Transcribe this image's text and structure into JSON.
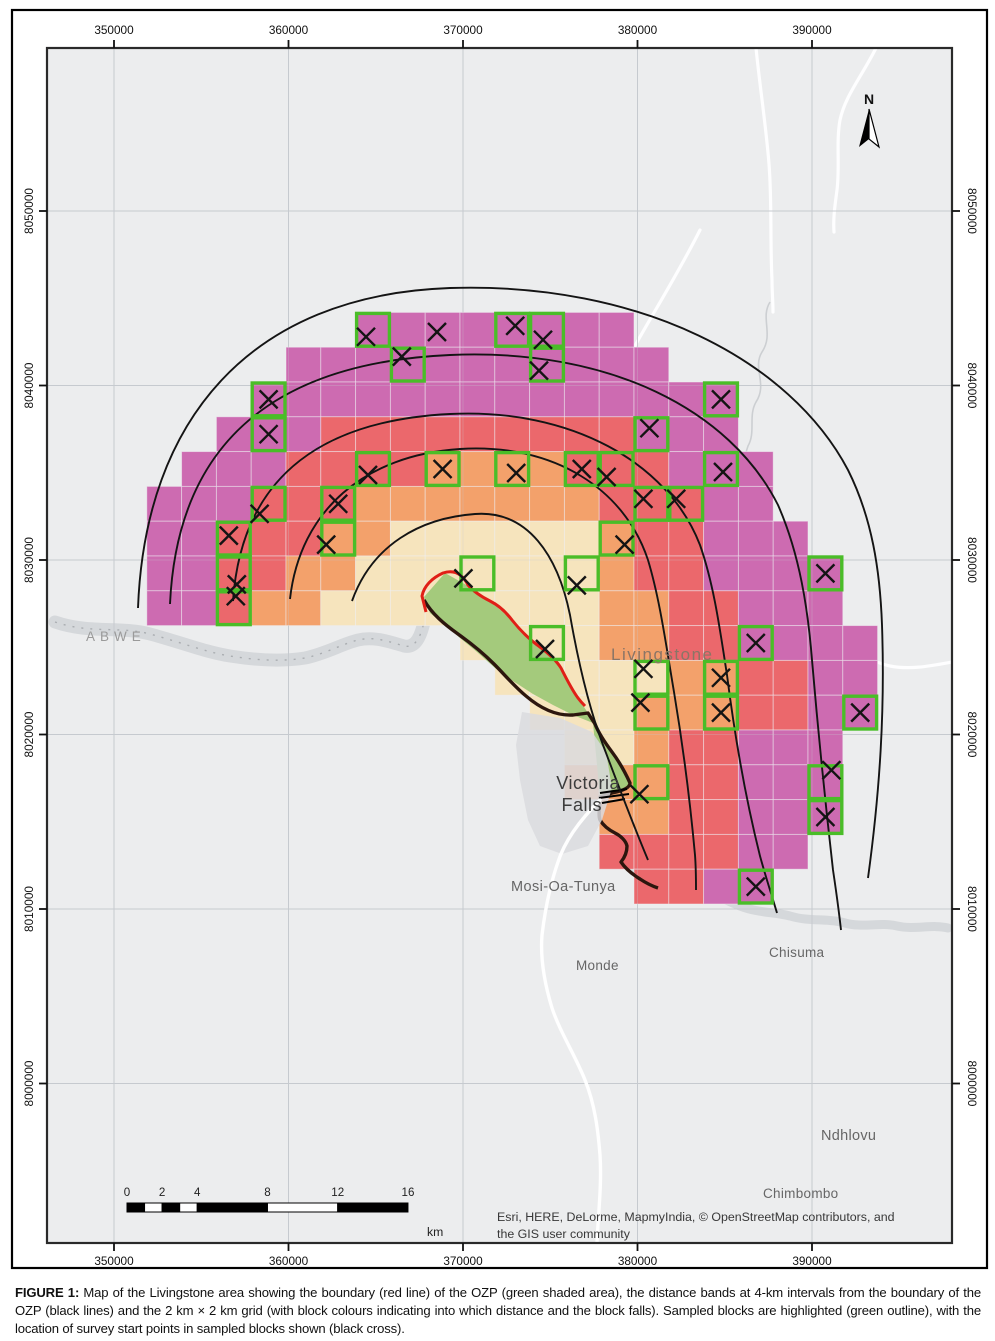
{
  "figure": {
    "caption_label": "FIGURE 1:",
    "caption_text": " Map of the Livingstone area showing the boundary (red line) of the OZP (green shaded area), the distance bands at 4-km intervals from the boundary of the OZP (black lines) and the 2 km × 2 km grid (with block colours indicating into which distance and the block falls). Sampled blocks are highlighted (green outline), with the location of survey start points in sampled blocks shown (black cross)."
  },
  "attribution": {
    "line1": "Esri, HERE, DeLorme, MapmyIndia, © OpenStreetMap contributors, and",
    "line2": "the GIS user community"
  },
  "north": {
    "label": "N",
    "x": 869,
    "y": 103
  },
  "scalebar": {
    "unit": "km",
    "x0": 127,
    "y0": 1203,
    "h": 9,
    "px_per_km": 17.56,
    "ticks": [
      {
        "label": "0",
        "km": 0
      },
      {
        "label": "2",
        "km": 2
      },
      {
        "label": "4",
        "km": 4
      },
      {
        "label": "8",
        "km": 8
      },
      {
        "label": "12",
        "km": 12
      },
      {
        "label": "16",
        "km": 16
      }
    ],
    "segments": [
      [
        0,
        1,
        "black"
      ],
      [
        1,
        2,
        "white"
      ],
      [
        2,
        3,
        "black"
      ],
      [
        3,
        4,
        "white"
      ],
      [
        4,
        8,
        "black"
      ],
      [
        8,
        12,
        "white"
      ],
      [
        12,
        16,
        "black"
      ]
    ],
    "unit_x": 427,
    "unit_y": 1236
  },
  "axes": {
    "x_ticks": [
      {
        "label": "350000",
        "x": 114
      },
      {
        "label": "360000",
        "x": 288.5
      },
      {
        "label": "370000",
        "x": 463
      },
      {
        "label": "380000",
        "x": 637.5
      },
      {
        "label": "390000",
        "x": 812
      }
    ],
    "y_ticks": [
      {
        "label": "8050000",
        "y": 211
      },
      {
        "label": "8040000",
        "y": 385.5
      },
      {
        "label": "8030000",
        "y": 560
      },
      {
        "label": "8020000",
        "y": 734.5
      },
      {
        "label": "8010000",
        "y": 909
      },
      {
        "label": "8000000",
        "y": 1083.5
      }
    ]
  },
  "map": {
    "page_border": {
      "x": 12,
      "y": 10,
      "w": 975,
      "h": 1258
    },
    "frame": {
      "x": 47,
      "y": 48,
      "w": 905,
      "h": 1195
    },
    "grid_origin": {
      "x": 112,
      "y": 208,
      "cell": 34.8
    },
    "colors": {
      "bg": "#ecedee",
      "magenta": "#cd6bb1",
      "red": "#eb686c",
      "orange": "#f3a16b",
      "cream": "#f6e4bd",
      "ozp_green": "#a4ca7c",
      "sample_outline": "#4abd28",
      "ozp_boundary_red": "#e01f17",
      "river_dark": "#2c160e",
      "arc": "#141414",
      "grid": "#c6cacf",
      "water": "#d3d5d8",
      "road": "#ffffff",
      "frame_stroke": "#2a2a2a",
      "label_gray": "#666666",
      "cross": "#141414"
    },
    "band_legend": [
      {
        "band": "0-4 km",
        "color_key": "cream"
      },
      {
        "band": "4-8 km",
        "color_key": "orange"
      },
      {
        "band": "8-12 km",
        "color_key": "red"
      },
      {
        "band": "12-16 km",
        "color_key": "magenta"
      }
    ],
    "blocks": [
      {
        "r": 3,
        "runs": [
          [
            7,
            14,
            "magenta"
          ]
        ]
      },
      {
        "r": 4,
        "runs": [
          [
            5,
            15,
            "magenta"
          ]
        ]
      },
      {
        "r": 5,
        "runs": [
          [
            4,
            17,
            "magenta"
          ]
        ]
      },
      {
        "r": 6,
        "runs": [
          [
            3,
            5,
            "magenta"
          ],
          [
            6,
            14,
            "red"
          ],
          [
            15,
            17,
            "magenta"
          ]
        ]
      },
      {
        "r": 7,
        "runs": [
          [
            2,
            4,
            "magenta"
          ],
          [
            5,
            8,
            "red"
          ],
          [
            9,
            12,
            "orange"
          ],
          [
            13,
            15,
            "red"
          ],
          [
            16,
            18,
            "magenta"
          ]
        ]
      },
      {
        "r": 8,
        "runs": [
          [
            1,
            3,
            "magenta"
          ],
          [
            4,
            6,
            "red"
          ],
          [
            7,
            13,
            "orange"
          ],
          [
            14,
            16,
            "red"
          ],
          [
            17,
            18,
            "magenta"
          ]
        ]
      },
      {
        "r": 9,
        "runs": [
          [
            1,
            2,
            "magenta"
          ],
          [
            3,
            5,
            "red"
          ],
          [
            6,
            7,
            "orange"
          ],
          [
            8,
            13,
            "cream"
          ],
          [
            14,
            14,
            "orange"
          ],
          [
            15,
            16,
            "red"
          ],
          [
            17,
            19,
            "magenta"
          ]
        ]
      },
      {
        "r": 10,
        "runs": [
          [
            1,
            2,
            "magenta"
          ],
          [
            3,
            4,
            "red"
          ],
          [
            5,
            6,
            "orange"
          ],
          [
            7,
            13,
            "cream"
          ],
          [
            14,
            14,
            "orange"
          ],
          [
            15,
            16,
            "red"
          ],
          [
            17,
            20,
            "magenta"
          ]
        ]
      },
      {
        "r": 11,
        "runs": [
          [
            1,
            2,
            "magenta"
          ],
          [
            3,
            3,
            "red"
          ],
          [
            4,
            5,
            "orange"
          ],
          [
            6,
            13,
            "cream"
          ],
          [
            14,
            15,
            "orange"
          ],
          [
            16,
            17,
            "red"
          ],
          [
            18,
            20,
            "magenta"
          ]
        ]
      },
      {
        "r": 12,
        "runs": [
          [
            10,
            13,
            "cream"
          ],
          [
            14,
            15,
            "orange"
          ],
          [
            16,
            17,
            "red"
          ],
          [
            18,
            21,
            "magenta"
          ]
        ]
      },
      {
        "r": 13,
        "runs": [
          [
            11,
            15,
            "cream"
          ],
          [
            16,
            17,
            "orange"
          ],
          [
            18,
            19,
            "red"
          ],
          [
            20,
            21,
            "magenta"
          ]
        ]
      },
      {
        "r": 14,
        "runs": [
          [
            12,
            14,
            "cream"
          ],
          [
            15,
            17,
            "orange"
          ],
          [
            18,
            19,
            "red"
          ],
          [
            20,
            21,
            "magenta"
          ]
        ]
      },
      {
        "r": 15,
        "runs": [
          [
            13,
            14,
            "cream"
          ],
          [
            15,
            15,
            "orange"
          ],
          [
            16,
            17,
            "red"
          ],
          [
            18,
            20,
            "magenta"
          ]
        ]
      },
      {
        "r": 16,
        "runs": [
          [
            13,
            15,
            "orange"
          ],
          [
            16,
            17,
            "red"
          ],
          [
            18,
            20,
            "magenta"
          ]
        ]
      },
      {
        "r": 17,
        "runs": [
          [
            14,
            15,
            "orange"
          ],
          [
            16,
            17,
            "red"
          ],
          [
            18,
            20,
            "magenta"
          ]
        ]
      },
      {
        "r": 18,
        "runs": [
          [
            14,
            17,
            "red"
          ],
          [
            18,
            19,
            "magenta"
          ]
        ]
      },
      {
        "r": 19,
        "runs": [
          [
            15,
            16,
            "red"
          ],
          [
            17,
            18,
            "magenta"
          ]
        ]
      }
    ],
    "sampled_blocks": [
      {
        "c": 7,
        "r": 3,
        "xo": -7,
        "yo": 7
      },
      {
        "c": 11,
        "r": 3,
        "xo": 3,
        "yo": -4
      },
      {
        "c": 12,
        "r": 3,
        "xo": -4,
        "yo": 10
      },
      {
        "c": 8,
        "r": 4,
        "xo": -6,
        "yo": -8
      },
      {
        "c": 12,
        "r": 4,
        "xo": -8,
        "yo": 6
      },
      {
        "c": 4,
        "r": 5,
        "xo": 0,
        "yo": 0
      },
      {
        "c": 17,
        "r": 5,
        "xo": 0,
        "yo": 0
      },
      {
        "c": 4,
        "r": 6,
        "xo": 0,
        "yo": 0
      },
      {
        "c": 15,
        "r": 6,
        "xo": -2,
        "yo": -6
      },
      {
        "c": 7,
        "r": 7,
        "xo": -5,
        "yo": 6
      },
      {
        "c": 9,
        "r": 7,
        "xo": 0,
        "yo": 0
      },
      {
        "c": 11,
        "r": 7,
        "xo": 4,
        "yo": 4
      },
      {
        "c": 13,
        "r": 7,
        "xo": 0,
        "yo": 0
      },
      {
        "c": 14,
        "r": 7,
        "xo": -10,
        "yo": 8
      },
      {
        "c": 17,
        "r": 7,
        "xo": 2,
        "yo": 3
      },
      {
        "c": 4,
        "r": 8,
        "xo": -9,
        "yo": 10
      },
      {
        "c": 6,
        "r": 8,
        "xo": 0,
        "yo": 0
      },
      {
        "c": 15,
        "r": 8,
        "xo": -8,
        "yo": -5
      },
      {
        "c": 16,
        "r": 8,
        "xo": -10,
        "yo": -5
      },
      {
        "c": 3,
        "r": 9,
        "xo": -5,
        "yo": -3
      },
      {
        "c": 6,
        "r": 9,
        "xo": -12,
        "yo": 6
      },
      {
        "c": 14,
        "r": 9,
        "xo": 8,
        "yo": 6
      },
      {
        "c": 3,
        "r": 10,
        "xo": 3,
        "yo": 11
      },
      {
        "c": 10,
        "r": 10,
        "xo": -14,
        "yo": 5
      },
      {
        "c": 13,
        "r": 10,
        "xo": -5,
        "yo": 12
      },
      {
        "c": 20,
        "r": 10,
        "xo": 0,
        "yo": 0
      },
      {
        "c": 3,
        "r": 11,
        "xo": 2,
        "yo": -12
      },
      {
        "c": 12,
        "r": 12,
        "xo": -2,
        "yo": 6
      },
      {
        "c": 18,
        "r": 12,
        "xo": 0,
        "yo": 0
      },
      {
        "c": 15,
        "r": 13,
        "xo": -8,
        "yo": -9
      },
      {
        "c": 17,
        "r": 13,
        "xo": 0,
        "yo": 0
      },
      {
        "c": 15,
        "r": 14,
        "xo": -11,
        "yo": -10
      },
      {
        "c": 17,
        "r": 14,
        "xo": 0,
        "yo": 0
      },
      {
        "c": 21,
        "r": 14,
        "xo": 0,
        "yo": 0
      },
      {
        "c": 15,
        "r": 16,
        "xo": -12,
        "yo": 12
      },
      {
        "c": 20,
        "r": 16,
        "xo": 6,
        "yo": -12
      },
      {
        "c": 20,
        "r": 17,
        "xo": 0,
        "yo": 0
      },
      {
        "c": 18,
        "r": 19,
        "xo": 0,
        "yo": 0
      }
    ],
    "loose_crosses": [
      {
        "x": 437,
        "y": 332
      }
    ],
    "arcs": [
      "M352,601 C372,545 420,518 475,514 C528,510 558,556 570,615 C577,655 588,705 603,745 C617,782 632,822 648,860",
      "M290,599 C300,510 365,455 460,449 C555,443 625,490 648,560 C660,600 666,645 674,692 C682,740 690,800 695,855 C696,868 696,878 696,890",
      "M233,601 C242,470 330,420 450,414 C570,408 668,462 700,545 C714,585 720,630 727,675 C735,738 746,800 760,856 C766,878 772,896 777,913",
      "M170,604 C178,430 290,362 450,355 C610,348 730,410 778,505 C800,555 808,610 812,660 C818,730 825,800 833,870 C836,890 839,912 841,930",
      "M138,608 C145,420 250,295 450,288 C640,282 790,360 848,470 C872,518 880,570 882,625 C885,710 880,790 868,878"
    ],
    "ozp_polygon": "M424,597 L445,573 L470,587 L490,601 L512,620 L540,647 L561,668 L578,698 L588,713 L595,724 L606,744 L615,755 L622,765 L628,778 L630,786 L612,792 L600,797 L593,723 L573,715 L553,705 L533,694 L513,681 L495,668 L477,652 L460,638 L445,625 L430,613 Z",
    "ozp_red_line": "M426,612 L422,596 C424,586 432,578 443,573 C455,569 463,575 468,585 C474,592 482,597 490,601 C498,605 506,612 512,620 C520,630 530,640 540,647 C548,653 556,660 561,668 C566,678 572,690 578,698 C581,702 584,705 585,706",
    "ozp_dark_line": "M424,600 C432,614 444,624 458,634 C472,644 484,654 494,664 C504,674 514,686 526,696 C540,708 556,716 573,715 L588,713 L595,724 C599,734 606,744 612,752 C618,760 625,772 630,783 C630,788 622,791 612,793 L600,797 C600,806 598,815 600,820 C603,825 609,830 615,833 C621,836 626,841 627,846 C627,851 625,857 621,862 C625,868 632,874 640,879 C646,883 652,886 658,888",
    "falls_hatch": [
      "M600,793 L627,789",
      "M599,798 L629,794",
      "M602,803 L625,799"
    ],
    "gorge_blob": "M522,712 L560,718 L592,732 L606,752 L612,788 L602,820 L588,846 L562,854 L540,846 L528,820 L520,780 L516,745 Z",
    "rivers": {
      "west": "M55,622 C90,634 120,626 150,634 C180,642 205,652 230,656 C255,660 280,662 305,658 C325,654 342,644 358,640 C374,636 390,642 404,646 C414,648 420,640 424,622",
      "east": "M630,868 C650,880 668,886 688,888 C710,890 724,900 740,906 C758,913 775,912 790,916 C810,922 828,918 845,923 C862,928 880,922 897,926 C915,930 932,924 948,928",
      "stream_ne": "M770,302 C760,318 774,334 762,352 C752,368 768,384 756,402 C748,416 756,432 748,446 C744,456 746,466 744,476"
    },
    "roads": [
      "M876,48 C862,76 845,96 840,120 C836,142 840,166 837,190 C835,205 833,218 834,232",
      "M756,48 C760,88 766,126 769,164 C772,202 770,240 772,280 C772,292 773,302 773,312",
      "M700,230 C680,270 655,310 636,344 C628,358 620,371 613,382",
      "M600,800 C580,820 565,840 558,862 C550,885 545,910 542,935 C540,960 545,985 552,1008 C560,1032 575,1055 585,1080 C595,1105 598,1130 600,1155 C602,1185 598,1215 597,1243",
      "M952,662 C930,666 910,670 890,666 C880,664 872,660 866,657"
    ],
    "labels": [
      {
        "text": "ABWE",
        "x": 86,
        "y": 641,
        "size": 13.5,
        "color": "#9a9a9a",
        "ls": 5,
        "anchor": "start"
      },
      {
        "text": "Livingstone",
        "x": 611,
        "y": 660,
        "size": 17,
        "color": "#8b7566",
        "ls": 1.5,
        "anchor": "start"
      },
      {
        "text": "Victoria",
        "x": 620,
        "y": 789,
        "size": 18,
        "color": "#3c3c3c",
        "ls": 0.5,
        "anchor": "end"
      },
      {
        "text": "Falls",
        "x": 602,
        "y": 811,
        "size": 18,
        "color": "#3c3c3c",
        "ls": 0.5,
        "anchor": "end"
      },
      {
        "text": "Mosi-Oa-Tunya",
        "x": 511,
        "y": 891,
        "size": 14.5,
        "color": "#666666",
        "ls": 0.4,
        "anchor": "start"
      },
      {
        "text": "Monde",
        "x": 576,
        "y": 970,
        "size": 13.5,
        "color": "#666666",
        "ls": 0.3,
        "anchor": "start"
      },
      {
        "text": "Chisuma",
        "x": 769,
        "y": 957,
        "size": 13.5,
        "color": "#666666",
        "ls": 0.3,
        "anchor": "start"
      },
      {
        "text": "Ndhlovu",
        "x": 821,
        "y": 1140,
        "size": 14.5,
        "color": "#666666",
        "ls": 0.3,
        "anchor": "start"
      },
      {
        "text": "Chimbombo",
        "x": 763,
        "y": 1198,
        "size": 13.5,
        "color": "#666666",
        "ls": 0.3,
        "anchor": "start"
      }
    ]
  }
}
